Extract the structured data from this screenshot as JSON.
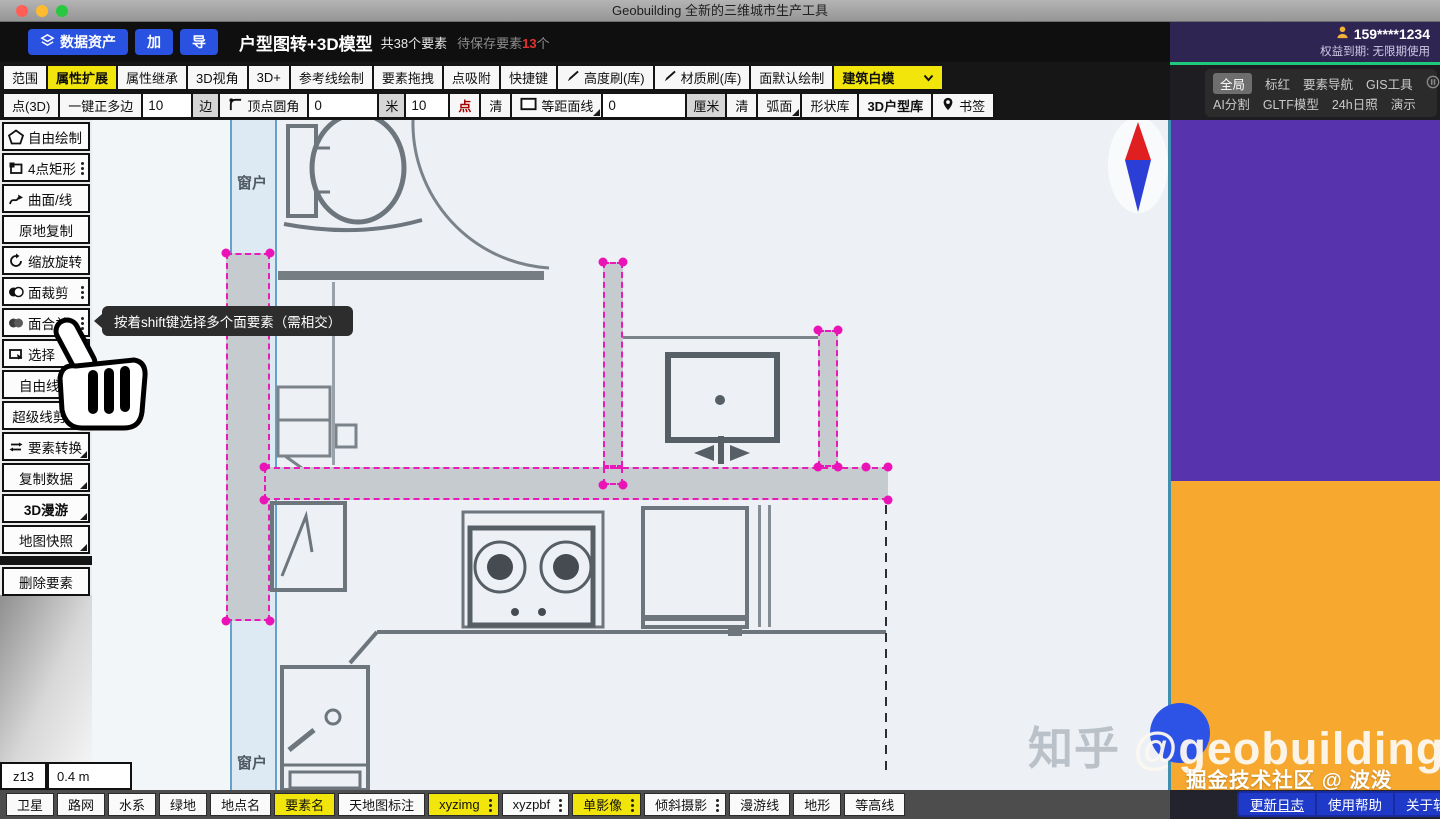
{
  "colors": {
    "accent_yellow": "#f2e50b",
    "selection_magenta": "#e81ab8",
    "brand_blue": "#2a52e0",
    "panel_purple": "#5733ad",
    "panel_orange": "#f7a92f",
    "license_green": "#1fc97c"
  },
  "titlebar": {
    "title": "Geobuilding 全新的三维城市生产工具"
  },
  "header": {
    "data_asset": "数据资产",
    "add_btn": "加",
    "export_btn": "导",
    "project_title": "户型图转+3D模型",
    "total_elements": "共38个要素",
    "unsaved_prefix": "待保存要素",
    "unsaved_count": "13",
    "unsaved_suffix": "个"
  },
  "account": {
    "phone": "159****1234",
    "license": "权益到期: 无限期使用"
  },
  "right_panel": {
    "global": "全局",
    "mark_red": "标红",
    "element_nav": "要素导航",
    "gis_tools": "GIS工具",
    "ai_split": "AI分割",
    "gltf_model": "GLTF模型",
    "sunlight_24h": "24h日照",
    "demo": "演示"
  },
  "toolbar1": {
    "items": [
      "范围",
      "属性扩展",
      "属性继承",
      "3D视角",
      "3D+",
      "参考线绘制",
      "要素拖拽",
      "点吸附",
      "快捷键",
      "高度刷(库)",
      "材质刷(库)",
      "面默认绘制"
    ],
    "mode_select": "建筑白模"
  },
  "toolbar2": {
    "point3d": "点(3D)",
    "one_key_poly": "一键正多边",
    "sides_value": "10",
    "sides_unit": "边",
    "vertex_fillet": "顶点圆角",
    "fillet_value": "0",
    "fillet_unit": "米",
    "snap_value": "10",
    "snap_point_label": "点",
    "clear_a": "清",
    "equidistant_line": "等距面线",
    "equi_value": "0",
    "equi_unit": "厘米",
    "clear_b": "清",
    "arc_face": "弧面",
    "shape_lib": "形状库",
    "house_lib": "3D户型库",
    "bookmark": "书签"
  },
  "sidebar": {
    "items": [
      "自由绘制",
      "4点矩形",
      "曲面/线",
      "原地复制",
      "缩放旋转",
      "面裁剪",
      "面合并",
      "选择",
      "自由线剪",
      "超级线剪刀",
      "要素转换",
      "复制数据",
      "3D漫游",
      "地图快照"
    ],
    "delete_item": "删除要素"
  },
  "tooltip": {
    "text": "按着shift键选择多个面要素（需相交）"
  },
  "canvas": {
    "window_label_top": "窗户",
    "window_label_bottom": "窗户",
    "zoom_level": "z13",
    "map_scale": "0.4 m"
  },
  "bottombar": {
    "items": [
      "卫星",
      "路网",
      "水系",
      "绿地",
      "地点名",
      "要素名",
      "天地图标注",
      "xyzimg",
      "xyzpbf",
      "单影像",
      "倾斜摄影",
      "漫游线",
      "地形",
      "等高线"
    ]
  },
  "watermark": {
    "zhihu": "知乎",
    "handle": "@geobuilding",
    "community": "掘金技术社区 @ 波泼"
  },
  "footer": {
    "changelog": "更新日志",
    "help": "使用帮助",
    "about": "关于软件"
  }
}
